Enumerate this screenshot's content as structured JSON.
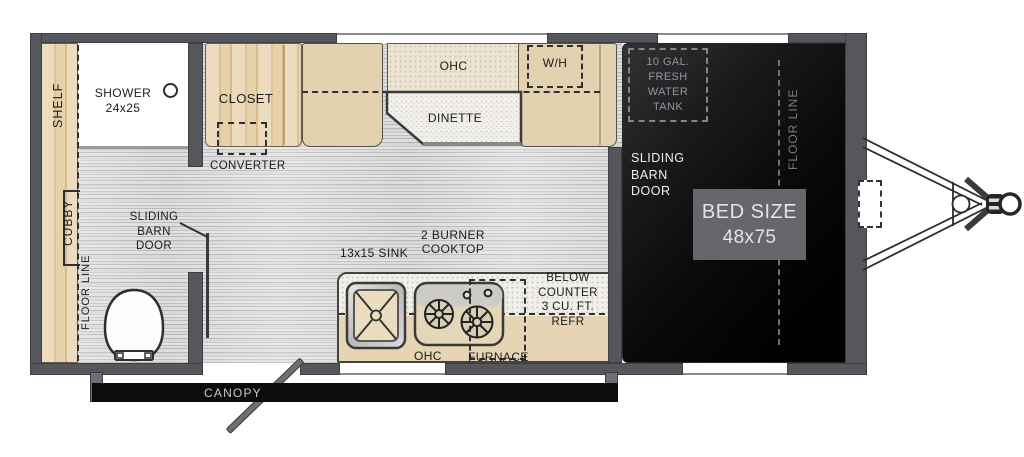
{
  "title": "travel trailer floor plan",
  "colors": {
    "wall": "#56575c",
    "cabinet_wood": "#e9d6b4",
    "bench_tan": "#e2d1ae",
    "overhead_cream": "#ece3d0",
    "bed_area": "#000000",
    "bed_size_box": "#66676c",
    "canopy_bar": "#0c0c0c",
    "label_text": "#1c1c1c",
    "muted_text": "#94959a"
  },
  "labels": {
    "shelf": "SHELF",
    "shower": [
      "SHOWER",
      "24x25"
    ],
    "closet": "CLOSET",
    "converter": "CONVERTER",
    "ohc_dinette": "OHC",
    "dinette": "DINETTE",
    "water_heater": "W/H",
    "fresh_tank": [
      "10 GAL.",
      "FRESH",
      "WATER",
      "TANK"
    ],
    "floor_line_right": "FLOOR LINE",
    "sliding_barn_door_bed": [
      "SLIDING",
      "BARN",
      "DOOR"
    ],
    "bed_size": [
      "BED SIZE",
      "48x75"
    ],
    "cubby": "CUBBY",
    "floor_line_left": "FLOOR LINE",
    "sliding_barn_door_bath": [
      "SLIDING",
      "BARN",
      "DOOR"
    ],
    "sink": "13x15 SINK",
    "cooktop": [
      "2 BURNER",
      "COOKTOP"
    ],
    "refrigerator": [
      "BELOW",
      "COUNTER",
      "3 CU. FT.",
      "REFR"
    ],
    "ohc_kitchen": "OHC",
    "furnace": "FURNACE",
    "canopy": "CANOPY"
  }
}
